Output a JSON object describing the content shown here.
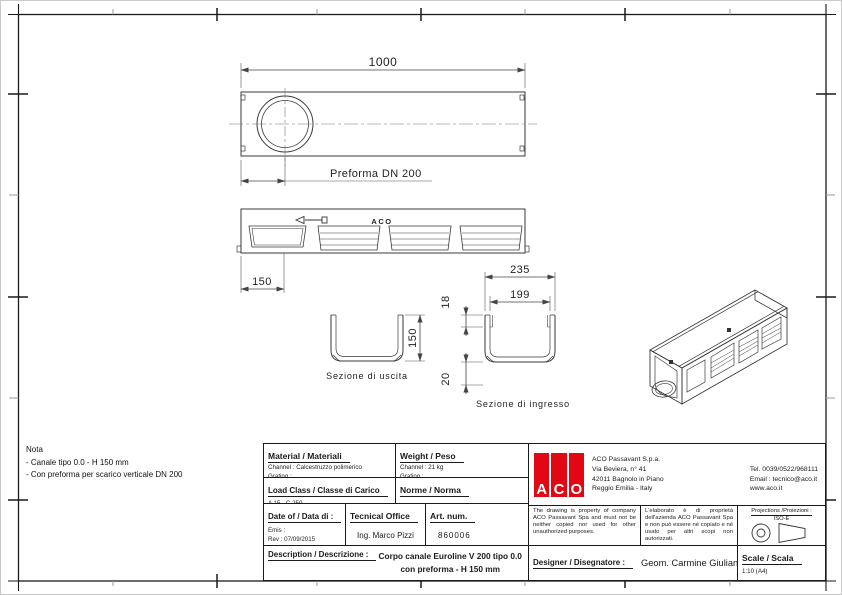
{
  "drawing": {
    "plan": {
      "length_dim": "1000",
      "preforma_label": "Preforma DN 200"
    },
    "elevation": {
      "brand": "ACO",
      "left_dim": "150"
    },
    "section_outlet": {
      "title": "Sezione di uscita",
      "height_dim": "150"
    },
    "section_inlet": {
      "title": "Sezione di ingresso",
      "outer_width_dim": "235",
      "inner_width_dim": "199",
      "edge_dim": "18",
      "bottom_dim": "20"
    }
  },
  "note": {
    "title": "Nota",
    "lines": [
      "- Canale tipo 0.0 - H 150 mm",
      "- Con preforma per scarico verticale DN 200"
    ]
  },
  "title_block": {
    "material": {
      "label": "Material / Materiali",
      "channel": "Channel : Calcestruzzo polimerico",
      "grating": "Grating :"
    },
    "weight": {
      "label": "Weight / Peso",
      "channel": "Channel : 21 kg",
      "grating": "Grating :"
    },
    "load_class": {
      "label": "Load Class / Classe di Carico",
      "value": "A 15 - C 250"
    },
    "norm": {
      "label": "Norme / Norma",
      "value": "UNI EN 1433"
    },
    "date": {
      "label": "Date of / Data di :",
      "emis": "Emis :",
      "rev": "Rev : 07/09/2015"
    },
    "office": {
      "label": "Tecnical Office",
      "value": "Ing. Marco Pizzi"
    },
    "artnum": {
      "label": "Art. num.",
      "value": "860006"
    },
    "description": {
      "label": "Description / Descrizione :",
      "line1": "Corpo canale Euroline V 200 tipo 0.0",
      "line2": "con preforma - H 150 mm"
    },
    "designer": {
      "label": "Designer / Disegnatore :",
      "value": "Geom. Carmine Giuliani"
    },
    "scale": {
      "label": "Scale / Scala",
      "value": "1:10 (A4)"
    },
    "projections": {
      "label": "Projections /Proiezioni :",
      "value": "ISO-E"
    },
    "legal_en": "The drawing is property of company ACO Passavant Spa and must not be neither copied nor used for other unauthorized purposes.",
    "legal_it": "L'elaborato è di proprietà dell'azienda ACO Passavant Spa e non può essere né copiato e né usato per altri scopi non autorizzati.",
    "company": {
      "logo_letters": [
        "A",
        "C",
        "O"
      ],
      "name": "ACO Passavant S.p.a.",
      "address1": "Via Beviera, n° 41",
      "address2": "42011 Bagnolo in Piano",
      "address3": "Reggio Emilia - Italy",
      "tel": "Tel. 0039/0522/968111",
      "email": "Email : tecnico@aco.it",
      "web": "www.aco.it"
    },
    "colors": {
      "logo_red": "#e30613"
    }
  }
}
